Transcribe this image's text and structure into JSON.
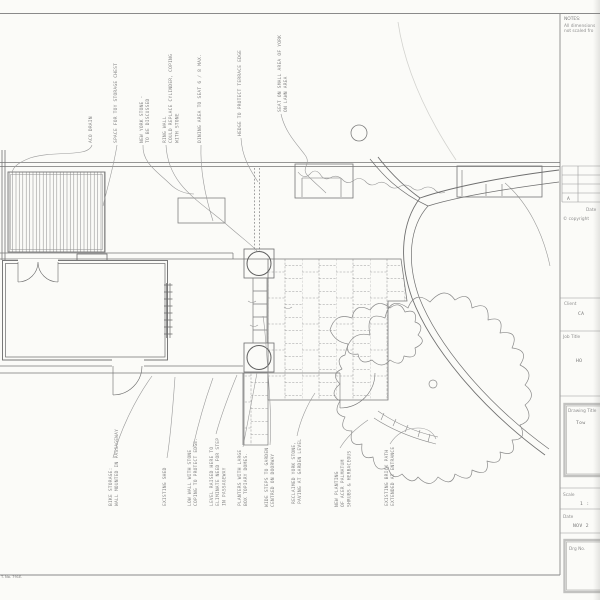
{
  "sheet": {
    "notes_title": "NOTES:",
    "notes_line1": "All dimensions",
    "notes_line2": "not scaled fro",
    "revision_row": "A",
    "revision_date_label": "Date",
    "copyright": "© copyright",
    "client_label": "Client",
    "client_value": "CA",
    "job_title_label": "Job Title",
    "job_title_value": "HO",
    "drawing_title_label": "Drawing Title",
    "drawing_title_value": "Tow",
    "scale_label": "Scale",
    "scale_value": "1 :",
    "date_label": "Date",
    "date_value": "NOV 2",
    "drg_no_label": "Drg No.",
    "footer_note": "T. No. 791E."
  },
  "plan": {
    "top_annotations": [
      {
        "lines": [
          "ACO DRAIN"
        ]
      },
      {
        "lines": [
          "SPACE FOR TOY STORAGE CHEST"
        ]
      },
      {
        "lines": [
          "NEW YORK STONE -",
          "TO BE DISCUSSED"
        ]
      },
      {
        "lines": [
          "RING WALL",
          "COULD REPLACE CYLINDER, COPING",
          "WITH STONE"
        ]
      },
      {
        "lines": [
          "DINING AREA TO SEAT 6 / 8 MAX."
        ]
      },
      {
        "lines": [
          "HEDGE TO PROTECT TERRACE EDGE"
        ]
      },
      {
        "lines": [
          "SEAT ON SMALL AREA OF YORK",
          "ON LAWN AREA"
        ]
      }
    ],
    "bottom_annotations": [
      {
        "lines": [
          "BIKE STORAGE:",
          "WALL MOUNTED IN PASSAGEWAY"
        ]
      },
      {
        "lines": [
          "EXISTING SHED"
        ]
      },
      {
        "lines": [
          "LOW WALL WITH STONE",
          "COPING TO PROTECT EDGE."
        ]
      },
      {
        "lines": [
          "LEVEL RAISED HERE TO",
          "ELIMINATE NEED FOR STEP",
          "IN PASSAGEWAY"
        ]
      },
      {
        "lines": [
          "PLANTERS WITH LARGE",
          "BOX TOPIARY DOMES."
        ]
      },
      {
        "lines": [
          "WIDE STEPS TO GARDEN",
          "CENTRED ON DOORWAY"
        ]
      },
      {
        "lines": [
          "RECLAIMED YORK STONE,",
          "PAVING AT GARDEN LEVEL"
        ]
      },
      {
        "lines": [
          "NEW PLANTING",
          "OF ACER PALMATUM",
          "SHRUBS & HERBACEOUS"
        ]
      },
      {
        "lines": [
          "EXISTING BRICK PATH",
          "EXTENDED AT ENTRANCE"
        ]
      }
    ]
  },
  "colors": {
    "paper": "#fbfbf8",
    "ink": "#6e6e6e",
    "pencil": "#8c8c8c",
    "leader": "#9a9a9a",
    "title_box_border": "#c2c2c0"
  }
}
